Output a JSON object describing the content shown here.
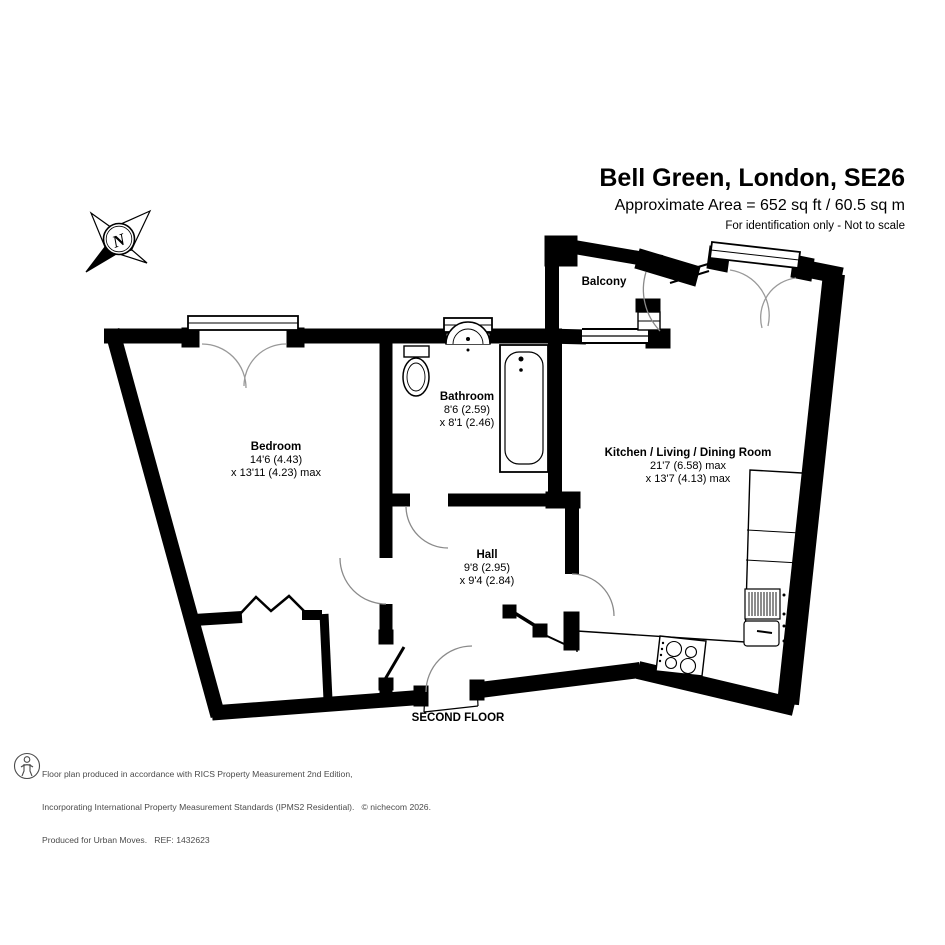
{
  "header": {
    "title": "Bell Green, London, SE26",
    "area_line": "Approximate Area = 652 sq ft / 60.5 sq m",
    "disclaimer": "For identification only - Not to scale"
  },
  "compass": {
    "label": "N"
  },
  "floor_label": "SECOND FLOOR",
  "rooms": [
    {
      "name": "Bedroom",
      "dim1": "14'6 (4.43)",
      "dim2": "x 13'11 (4.23) max"
    },
    {
      "name": "Bathroom",
      "dim1": "8'6 (2.59)",
      "dim2": "x 8'1 (2.46)"
    },
    {
      "name": "Hall",
      "dim1": "9'8 (2.95)",
      "dim2": "x 9'4 (2.84)"
    },
    {
      "name": "Kitchen / Living / Dining Room",
      "dim1": "21'7 (6.58) max",
      "dim2": "x 13'7 (4.13) max"
    },
    {
      "name": "Balcony",
      "dim1": "",
      "dim2": ""
    }
  ],
  "footer": {
    "line1": "Floor plan produced in accordance with RICS Property Measurement 2nd Edition,",
    "line2": "Incorporating International Property Measurement Standards (IPMS2 Residential).   © nichecom 2026.",
    "line3": "Produced for Urban Moves.   REF: 1432623"
  }
}
